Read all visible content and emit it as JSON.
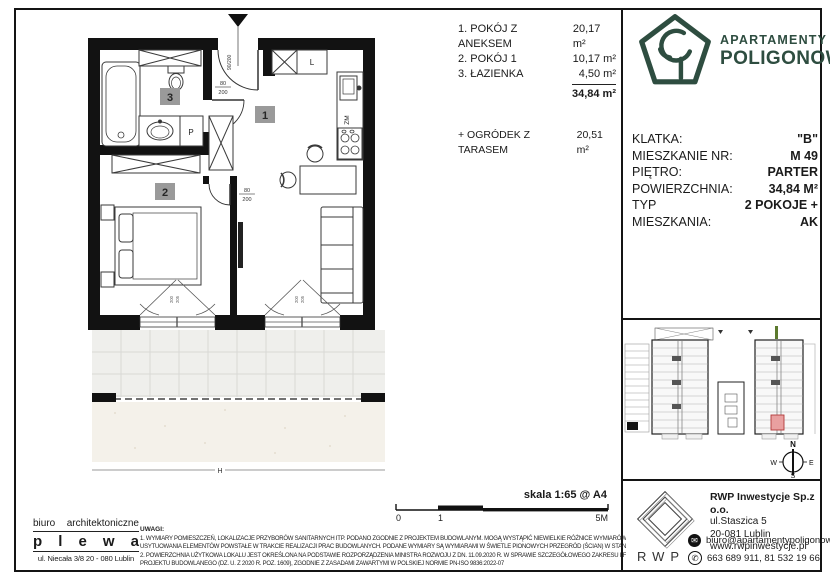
{
  "brand": {
    "line1": "APARTAMENTY",
    "line2": "POLIGONOWA",
    "green": "#2e4d40"
  },
  "room_list": {
    "items": [
      {
        "name": "1. POKÓJ Z ANEKSEM",
        "area": "20,17 m²"
      },
      {
        "name": "2. POKÓJ 1",
        "area": "10,17 m²"
      },
      {
        "name": "3. ŁAZIENKA",
        "area": "4,50 m²"
      }
    ],
    "total": "34,84 m²",
    "garden_label": "+ OGRÓDEK Z TARASEM",
    "garden_area": "20,51 m²"
  },
  "unit_info": {
    "rows": [
      {
        "label": "KLATKA:",
        "value": "\"B\""
      },
      {
        "label": "MIESZKANIE NR:",
        "value": "M  49"
      },
      {
        "label": "PIĘTRO:",
        "value": "PARTER"
      },
      {
        "label": "POWIERZCHNIA:",
        "value": "34,84 M²"
      },
      {
        "label": "TYP MIESZKANIA:",
        "value": "2 POKOJE + AK"
      }
    ]
  },
  "plan": {
    "room1": "1",
    "room2": "2",
    "room3": "3",
    "entry_dim": "90/200",
    "door_w": "80",
    "door_h": "200",
    "fridge": "L",
    "dishwasher": "ZM",
    "washer": "P",
    "window_w": "200",
    "window_h": "205",
    "section_mark": "H",
    "highlight_pink": "#e9a0a0"
  },
  "scale": {
    "label": "skala 1:65 @ A4",
    "tick0": "0",
    "tick1": "1",
    "tick2": "5M"
  },
  "architect": {
    "word1": "biuro",
    "word2": "architektoniczne",
    "letters": [
      "p",
      "l",
      "e",
      "w",
      "a"
    ],
    "address": "ul. Niecała 3/8  20 - 080 Lublin"
  },
  "notes": {
    "heading": "UWAGI:",
    "line1": "1. WYMIARY POMIESZCZEŃ, LOKALIZACJE PRZYBORÓW SANITARNYCH ITP. PODANO ZGODNIE Z PROJEKTEM BUDOWLANYM. MOGĄ WYSTĄPIĆ NIEWIELKIE RÓŻNICE WYMIARÓW I",
    "line2": "USYTUOWANIA ELEMENTÓW POWSTAŁE W TRAKCIE REALIZACJI PRAC BUDOWLANYCH. PODANE WYMIARY SĄ WYMIARAMI W ŚWIETLE PIONOWYCH PRZEGRÓD (ŚCIAN) W STANIE SUROWYM.",
    "line3": "2. POWIERZCHNIA UŻYTKOWA LOKALU JEST OKREŚLONA NA PODSTAWIE ROZPORZĄDZENIA MINISTRA ROZWOJU Z DN. 11.09.2020 R. W SPRAWIE SZCZEGÓŁOWEGO ZAKRESU I FORMY",
    "line4": "PROJEKTU BUDOWLANEGO (DZ. U. Z 2020 R. POZ. 1609), ZGODNIE Z ZASADAMI ZAWARTYMI W POLSKIEJ NORMIE PN-ISO 9836:2022-07"
  },
  "developer": {
    "logo": "RWP",
    "company": "RWP Inwestycje Sp.z o.o.",
    "street": "ul.Staszica 5",
    "city": "20-081 Lublin",
    "www": "www.rwpinwestycje.pl",
    "email": "biuro@apartamentypoligonowa.pl",
    "phones": "663 689 911,  81 532 19 66",
    "mail_glyph": "✉",
    "phone_glyph": "✆"
  },
  "compass": {
    "n": "N",
    "e": "E",
    "s": "S",
    "w": "W"
  }
}
